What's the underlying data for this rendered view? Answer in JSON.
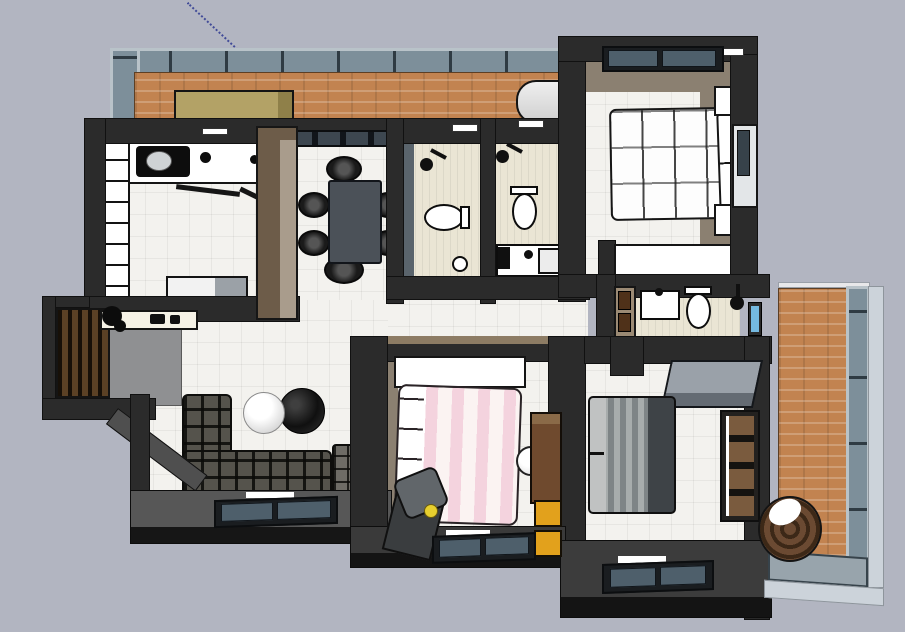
{
  "view": {
    "type": "3d-floor-plan-top-view",
    "renderer": "sketchup-style-viewport",
    "visible_text": []
  },
  "palette": {
    "bg": "#b2b5c1",
    "wall": "#2b2b2b",
    "wallEdge": "#111111",
    "wallLight": "#4f4f4f",
    "taupe": "#8b8071",
    "tanCap": "#8d7c64",
    "tile": "#f3f2ee",
    "bathFloor": "#eae5d4",
    "entry": "#8f9092",
    "brick": "#c28350",
    "glassPane": "#7d8f9a",
    "glassMullion": "#2f3b43",
    "glassFrame": "#b9c3c9",
    "glassLight": "#ccd3da",
    "winGlass": "#4e5f6b",
    "sofa": "#55534c",
    "sofaEnd": "#6e6c66",
    "table": "#4b5158",
    "khaki": "#b3a266",
    "brownCabinet": "#6f4a2e",
    "orangeDrawer": "#e2a11c",
    "deskGray": "#9aa1a9",
    "bedGrayBlanket": "#7e8486",
    "bedPink": "#f4d3de",
    "potBrown": "#5d4027",
    "axisBlue": "#26318e"
  },
  "scene": {
    "rooms": [
      {
        "name": "top-balcony",
        "floor": "brick",
        "furniture": [
          "storage-chest",
          "washing-machine"
        ]
      },
      {
        "name": "kitchen",
        "floor": "white-tile",
        "furniture": [
          "cabinet-column",
          "counter-sink",
          "fridge"
        ]
      },
      {
        "name": "dining-area",
        "floor": "white-tile",
        "furniture": [
          "dining-table",
          "six-chairs"
        ]
      },
      {
        "name": "bathroom-left",
        "floor": "beige-tile",
        "furniture": [
          "shower-head",
          "toilet",
          "floor-drain"
        ]
      },
      {
        "name": "bathroom-right",
        "floor": "beige-tile",
        "furniture": [
          "shower-head",
          "toilet",
          "vanity-sink",
          "mirror"
        ]
      },
      {
        "name": "master-bedroom",
        "floor": "white-tile",
        "furniture": [
          "double-bed-plaid",
          "nightstand-top",
          "nightstand-bottom",
          "dresser",
          "window-top",
          "window-right"
        ]
      },
      {
        "name": "ensuite-bathroom",
        "floor": "beige-tile",
        "furniture": [
          "sink",
          "toilet",
          "shower-head",
          "brown-cabinet",
          "blue-window"
        ]
      },
      {
        "name": "entry-nook",
        "floor": "gray-slab",
        "furniture": [
          "wood-slat-screen",
          "console-table",
          "plant"
        ]
      },
      {
        "name": "living-room",
        "floor": "white-tile",
        "furniture": [
          "l-shaped-sofa",
          "white-round-rug",
          "black-round-rug",
          "window-bottom"
        ]
      },
      {
        "name": "pink-bedroom",
        "floor": "white-tile",
        "furniture": [
          "pink-striped-bed",
          "white-wardrobe",
          "desk",
          "desk-chair",
          "brown-cabinet-orange-drawers",
          "ball-stool",
          "window-bottom"
        ]
      },
      {
        "name": "gray-bedroom",
        "floor": "white-tile",
        "furniture": [
          "gray-bed",
          "corner-desk",
          "shelf-wardrobe",
          "window-bottom"
        ]
      },
      {
        "name": "right-balcony",
        "floor": "brick",
        "furniture": [
          "round-planter"
        ],
        "enclosure": "glazed-windows"
      }
    ]
  }
}
